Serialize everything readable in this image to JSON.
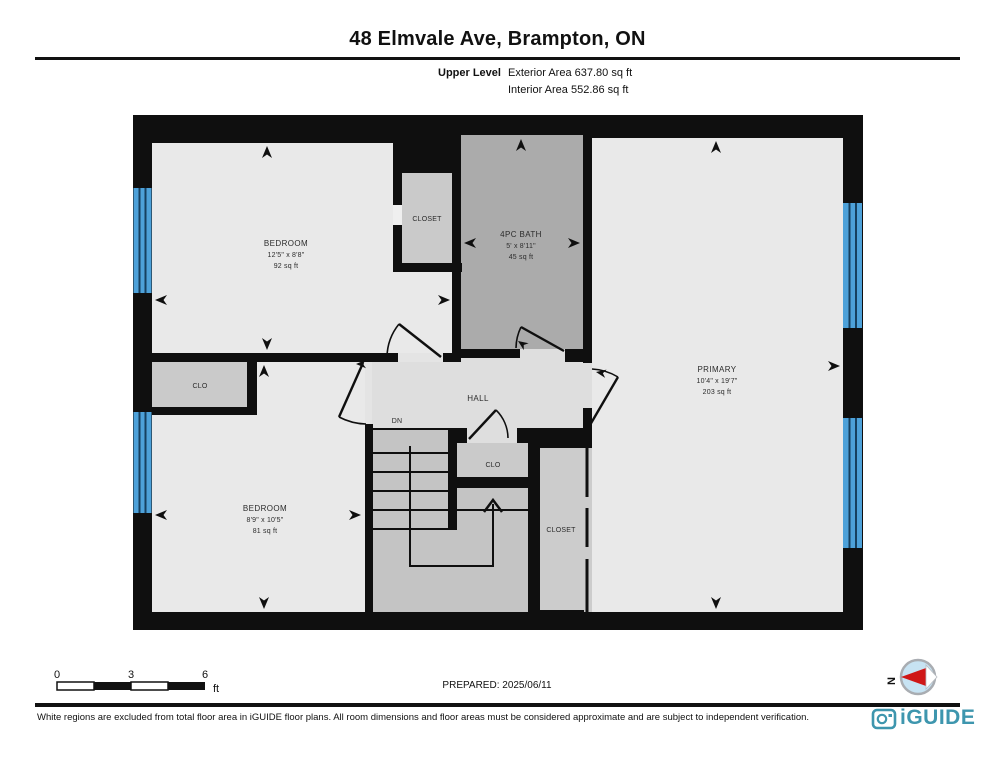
{
  "header": {
    "title": "48 Elmvale Ave, Brampton, ON",
    "level": "Upper Level",
    "exterior_area": "Exterior Area 637.80 sq ft",
    "interior_area": "Interior Area 552.86 sq ft"
  },
  "rooms": {
    "bedroom1": {
      "name": "BEDROOM",
      "dims": "12'5\" x 8'8\"",
      "area": "92 sq ft"
    },
    "closet1": {
      "name": "CLOSET"
    },
    "bath": {
      "name": "4PC BATH",
      "dims": "5' x 8'11\"",
      "area": "45 sq ft"
    },
    "primary": {
      "name": "PRIMARY",
      "dims": "10'4\" x 19'7\"",
      "area": "203 sq ft"
    },
    "clo_bedroom2": {
      "name": "CLO"
    },
    "hall": {
      "name": "HALL"
    },
    "stairs": {
      "name": "DN"
    },
    "bedroom2": {
      "name": "BEDROOM",
      "dims": "8'9\" x 10'5\"",
      "area": "81 sq ft"
    },
    "clo_stairs": {
      "name": "CLO"
    },
    "closet2": {
      "name": "CLOSET"
    }
  },
  "scale_bar": {
    "labels": [
      "0",
      "3",
      "6"
    ],
    "unit": "ft"
  },
  "footer": {
    "prepared": "PREPARED: 2025/06/11",
    "compass_label": "N",
    "disclaimer": "White regions are excluded from total floor area in iGUIDE floor plans. All room dimensions and floor areas must be considered approximate and are subject to independent verification.",
    "brand": "iGUIDE"
  },
  "colors": {
    "wall": "#0f0f0f",
    "room": "#e9e9e9",
    "hall": "#dedede",
    "bath": "#ababab",
    "closet": "#cacaca",
    "stairs": "#c4c4c4",
    "window": "#4da1d9",
    "brand": "#3e96ae",
    "compass_red": "#cf1717",
    "compass_fill": "#c7e3f3"
  }
}
